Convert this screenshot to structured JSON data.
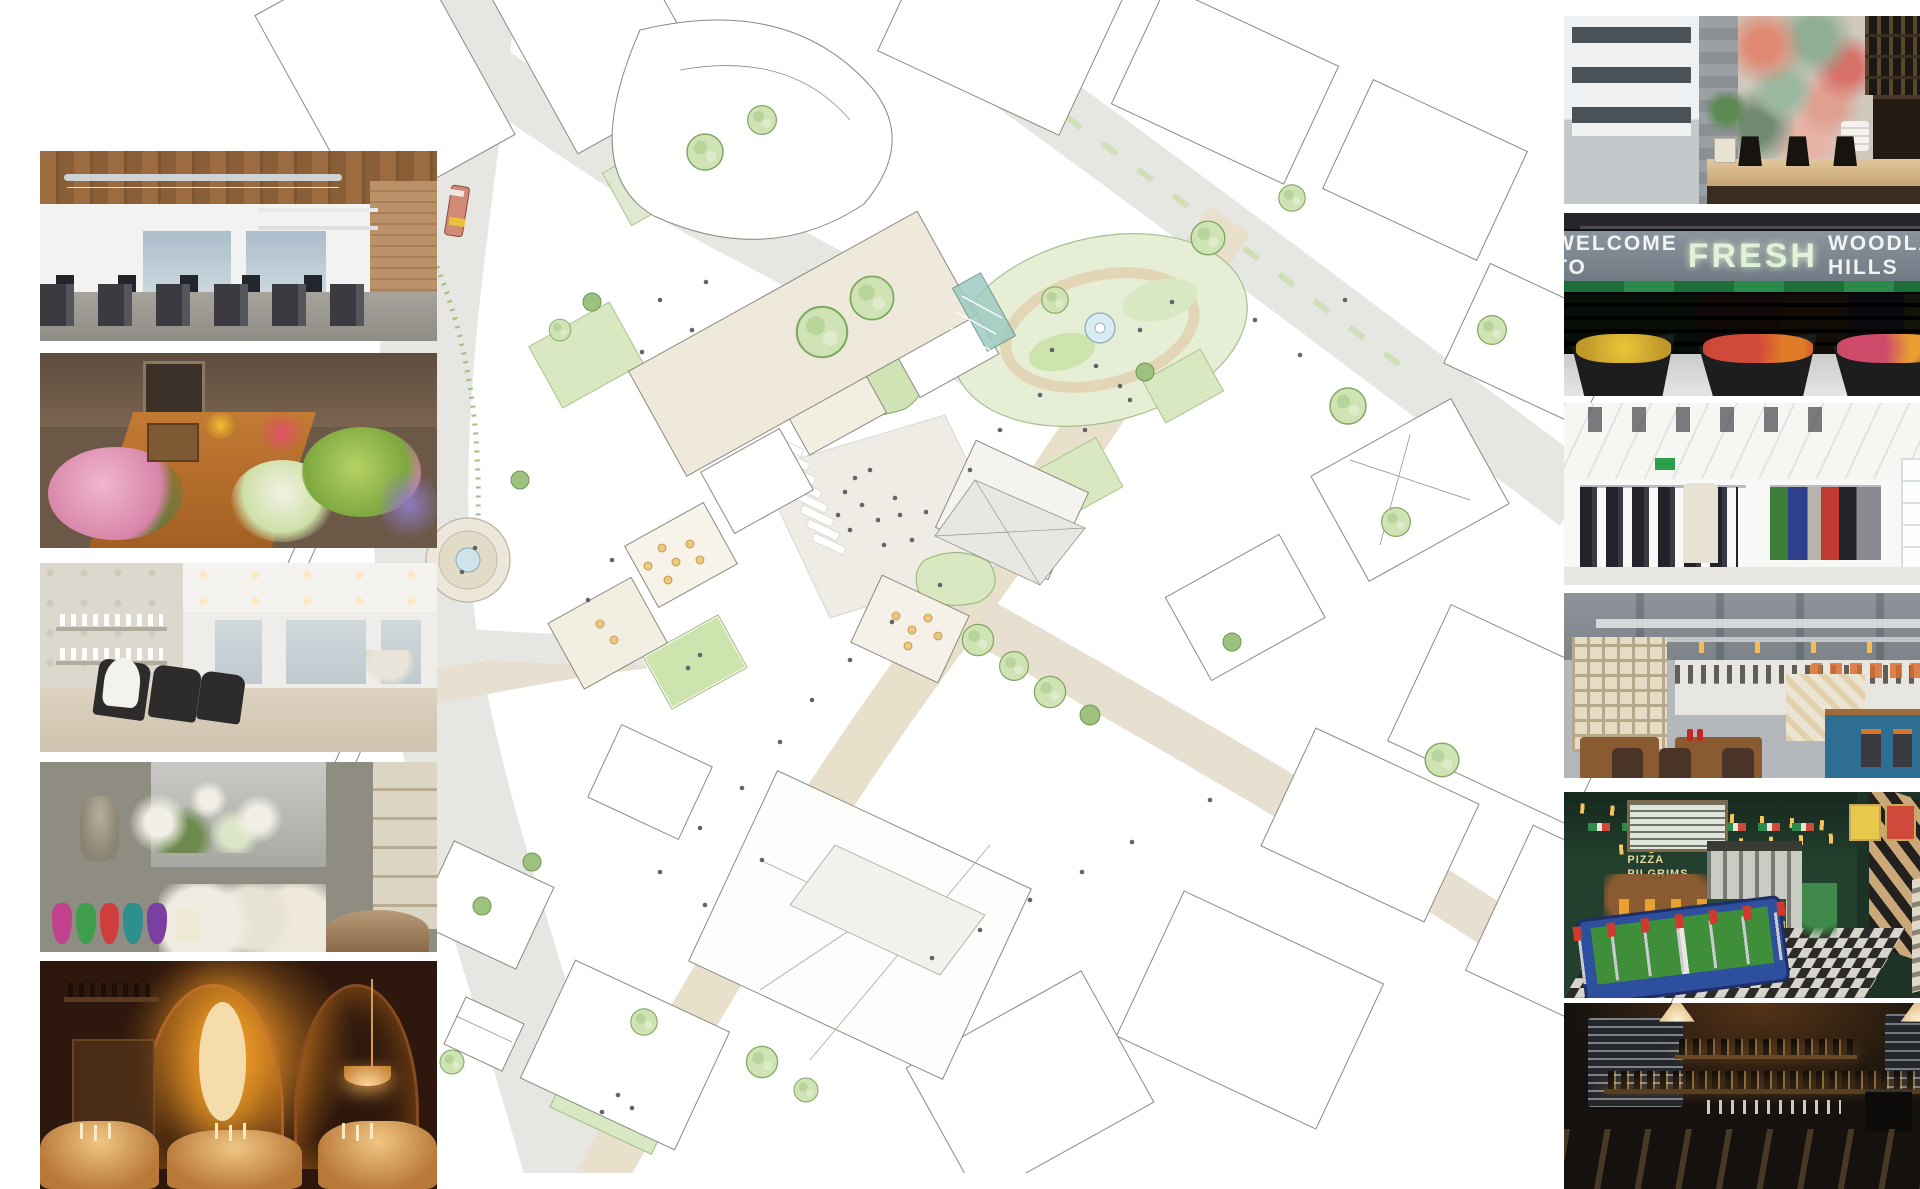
{
  "board": {
    "type": "masterplan mood-board collage",
    "background": "#ffffff"
  },
  "masterplan": {
    "colors": {
      "line": "#8b8a80",
      "road_grey": "#e6e6e3",
      "street_tan": "#e9e0cc",
      "plaza": "#efece6",
      "lawn_light": "#dce9c6",
      "lawn_mid": "#c9e0ac",
      "tree_green": "#cfe3b4",
      "tree_edge": "#7fa862",
      "water": "#cfe3ea",
      "canopy_teal": "#9ecbc2",
      "bus_red": "#d08a76",
      "bus_stripe_yellow": "#e9c23c",
      "bus_window_teal": "#bfe0dd",
      "interior_cream": "#f3eee2",
      "table_amber": "#ecc97e"
    }
  },
  "photos": {
    "left": [
      {
        "subject": "open-plan office with timber ceiling and brick wall"
      },
      {
        "subject": "florist shop interior full of flower buckets"
      },
      {
        "subject": "hair salon with wash stations and product shelves"
      },
      {
        "subject": "flower and home decor boutique with coloured glass vases"
      },
      {
        "subject": "candle-lit restaurant under brick arches"
      }
    ],
    "right": [
      {
        "subject": "coffee bar with illustrated mural and street window"
      },
      {
        "subject": "fresh food market hall with produce aisles"
      },
      {
        "subject": "white fashion boutique with clothing rails"
      },
      {
        "subject": "industrial diner with breeze-block screen and blue bar"
      },
      {
        "subject": "games room with foosball table and chevron staircase"
      },
      {
        "subject": "dark craft-beer bar with chalkboard menus"
      }
    ]
  },
  "signs": {
    "fresh_market": {
      "prefix": "WELCOME TO",
      "brand": "FRESH",
      "suffix": "WOODLAND HILLS"
    },
    "games_room": {
      "line1": "PIZZA",
      "line2": "PILGRIMS"
    }
  }
}
